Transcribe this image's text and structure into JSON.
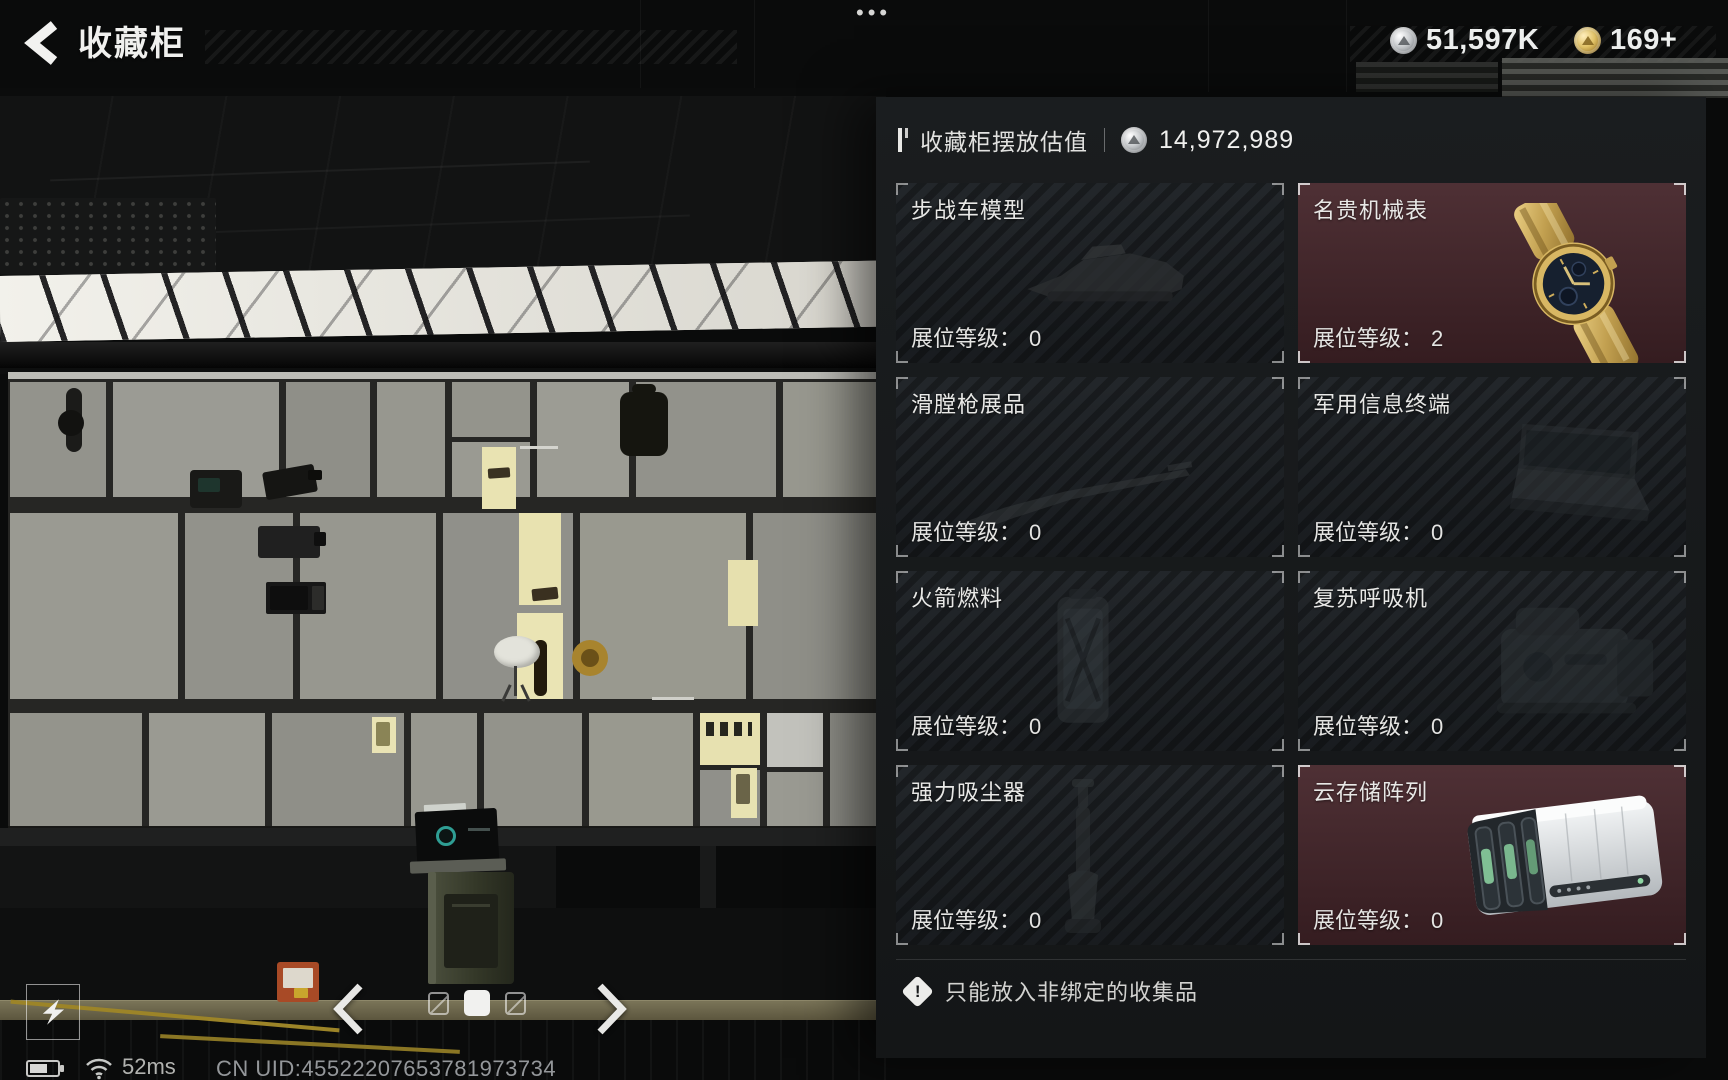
{
  "header": {
    "title": "收藏柜",
    "menu_dots": "•••",
    "currencies": [
      {
        "icon": "silver-coin-icon",
        "value": "51,597K"
      },
      {
        "icon": "gold-coin-icon",
        "value": "169+"
      }
    ]
  },
  "valuation": {
    "label": "收藏柜摆放估值",
    "icon": "silver-coin-icon",
    "value": "14,972,989"
  },
  "cards": [
    {
      "title": "步战车模型",
      "level_label": "展位等级：",
      "level": "0",
      "highlight": false,
      "item_icon": "ifv-model-icon"
    },
    {
      "title": "名贵机械表",
      "level_label": "展位等级：",
      "level": "2",
      "highlight": true,
      "item_icon": "gold-watch-icon"
    },
    {
      "title": "滑膛枪展品",
      "level_label": "展位等级：",
      "level": "0",
      "highlight": false,
      "item_icon": "musket-icon"
    },
    {
      "title": "军用信息终端",
      "level_label": "展位等级：",
      "level": "0",
      "highlight": false,
      "item_icon": "military-terminal-icon"
    },
    {
      "title": "火箭燃料",
      "level_label": "展位等级：",
      "level": "0",
      "highlight": false,
      "item_icon": "rocket-fuel-icon"
    },
    {
      "title": "复苏呼吸机",
      "level_label": "展位等级：",
      "level": "0",
      "highlight": false,
      "item_icon": "ventilator-icon"
    },
    {
      "title": "强力吸尘器",
      "level_label": "展位等级：",
      "level": "0",
      "highlight": false,
      "item_icon": "vacuum-icon"
    },
    {
      "title": "云存储阵列",
      "level_label": "展位等级：",
      "level": "0",
      "highlight": true,
      "item_icon": "cloud-storage-icon"
    }
  ],
  "warning": "只能放入非绑定的收集品",
  "pager": {
    "count": 3,
    "active_index": 1
  },
  "status": {
    "ping": "52ms",
    "uid": "CN UID:45522207653781973734"
  },
  "colors": {
    "highlight_card": "#45252a",
    "card": "#1e2226",
    "panel": "#1a1d1f"
  }
}
